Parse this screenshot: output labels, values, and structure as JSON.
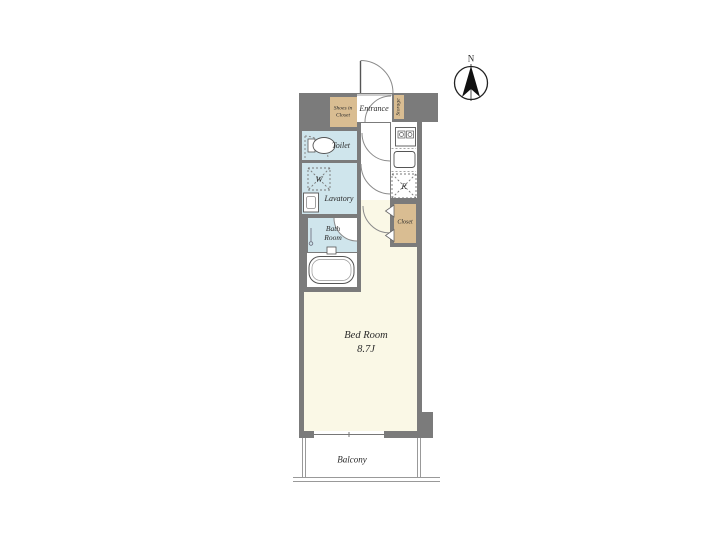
{
  "compass": {
    "north_label": "N"
  },
  "rooms": {
    "shoes_in_closet": {
      "label": "Shoes in\nCloset"
    },
    "entrance": {
      "label": "Entrance"
    },
    "storage": {
      "label": "Storage"
    },
    "toilet": {
      "label": "Toilet"
    },
    "washer": {
      "label": "W"
    },
    "lavatory": {
      "label": "Lavatory"
    },
    "bath_room": {
      "label": "Bath\nRoom"
    },
    "refrigerator": {
      "label": "R"
    },
    "closet": {
      "label": "Closet"
    },
    "bed_room": {
      "label": "Bed Room",
      "size": "8.7J",
      "label_full": "Bed Room\n8.7J"
    },
    "balcony": {
      "label": "Balcony"
    }
  },
  "colors": {
    "wall_gray": "#7b7b7b",
    "closet_tan": "#d9bd92",
    "wet_area_blue": "#cfe5ec",
    "bedroom_cream": "#faf8e6",
    "line_dark": "#555555",
    "background": "#ffffff"
  }
}
